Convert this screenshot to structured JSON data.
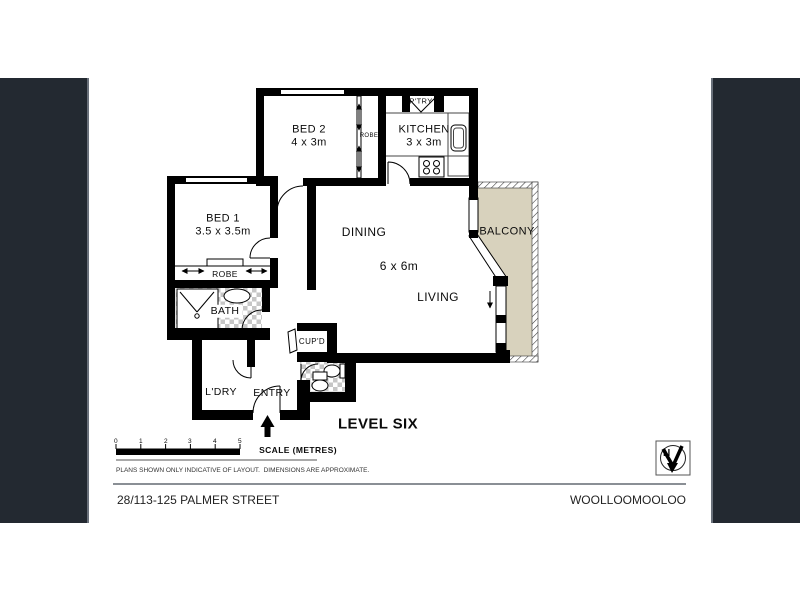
{
  "plan": {
    "rooms": {
      "bed2": {
        "name": "BED 2",
        "dims": "4 x 3m"
      },
      "kitchen": {
        "name": "KITCHEN",
        "dims": "3 x 3m"
      },
      "bed1": {
        "name": "BED 1",
        "dims": "3.5 x 3.5m"
      },
      "dining": {
        "name": "DINING"
      },
      "living": {
        "name": "LIVING"
      },
      "living_dims": "6 x 6m",
      "balcony": {
        "name": "BALCONY"
      },
      "bath": {
        "name": "BATH"
      },
      "ldry": {
        "name": "L'DRY"
      },
      "entry": {
        "name": "ENTRY"
      },
      "cupd": {
        "name": "CUP'D"
      },
      "ptry": {
        "name": "P'TRY"
      },
      "robe_bed1": {
        "name": "ROBE"
      },
      "robe_bed2": {
        "name": "ROBE"
      }
    },
    "level_label": "LEVEL SIX",
    "scale": {
      "label": "SCALE (METRES)",
      "marks": [
        "0",
        "1",
        "2",
        "3",
        "4",
        "5"
      ]
    },
    "disclaimer": "PLANS SHOWN ONLY INDICATIVE OF LAYOUT.  DIMENSIONS ARE APPROXIMATE.",
    "compass": {
      "label": "N"
    }
  },
  "footer": {
    "address": "28/113-125 PALMER STREET",
    "suburb": "WOOLLOOMOOLOO"
  },
  "colors": {
    "wall": "#000000",
    "balcony_fill": "#d8d2bd",
    "side_bar": "#232931",
    "tile_gray": "#c6c6c6"
  }
}
